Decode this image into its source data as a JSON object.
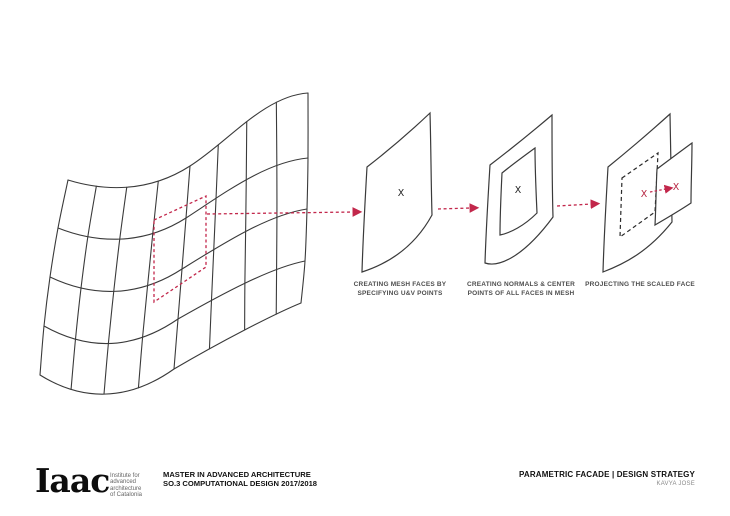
{
  "colors": {
    "line": "#3a3a3a",
    "accent": "#c2274b",
    "caption": "#4d4d4d",
    "background": "#ffffff"
  },
  "diagram": {
    "face_marker": "X",
    "steps": [
      {
        "caption_line1": "CREATING MESH FACES BY",
        "caption_line2": "SPECIFYING U&V POINTS"
      },
      {
        "caption_line1": "CREATING NORMALS & CENTER",
        "caption_line2": "POINTS OF ALL FACES IN MESH"
      },
      {
        "caption_line1": "PROJECTING THE SCALED FACE",
        "caption_line2": ""
      }
    ]
  },
  "footer": {
    "logo_text": "Iaac",
    "logo_subtitle_lines": [
      "Institute for",
      "advanced",
      "architecture",
      "of Catalonia"
    ],
    "course_line1": "MASTER IN ADVANCED ARCHITECTURE",
    "course_line2": "SO.3 COMPUTATIONAL DESIGN 2017/2018",
    "project_title": "PARAMETRIC FACADE |  DESIGN STRATEGY",
    "author": "KAVYA JOSE"
  }
}
